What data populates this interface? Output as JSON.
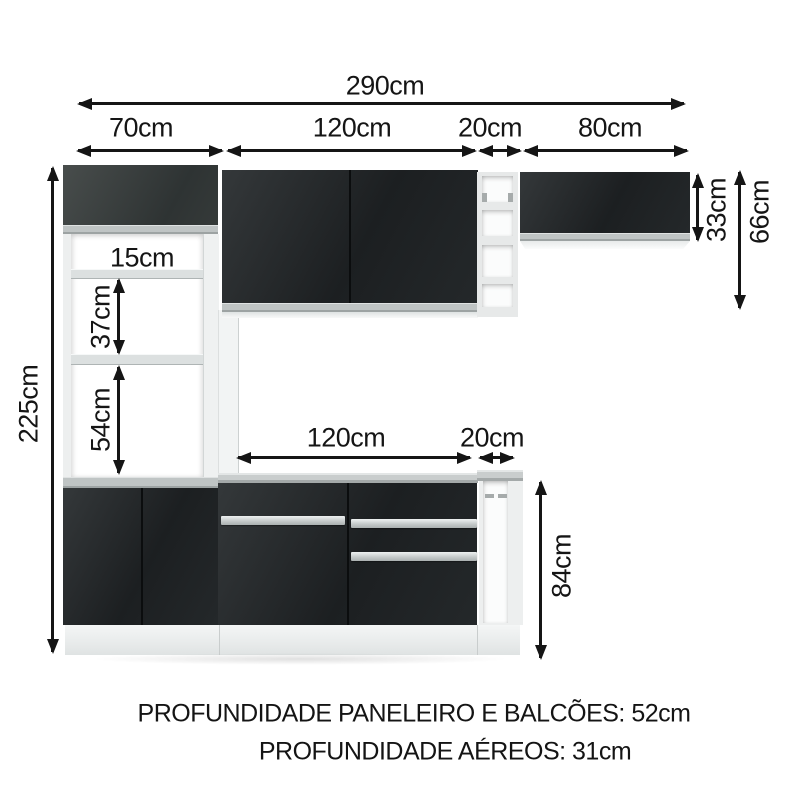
{
  "diagram": {
    "dims": {
      "total_width": "290cm",
      "tall_cabinet_width": "70cm",
      "wall_cabinet_width": "120cm",
      "niche_width": "20cm",
      "right_cabinet_width": "80cm",
      "total_height": "225cm",
      "niche_gap_top": "15cm",
      "niche_gap_middle": "37cm",
      "niche_gap_bottom": "54cm",
      "counter_width": "120cm",
      "counter_side_width": "20cm",
      "counter_height": "84cm",
      "right_cabinet_height": "33cm",
      "right_section_height": "66cm"
    },
    "footer": {
      "line1": "PROFUNDIDADE PANELEIRO E BALCÕES: 52cm",
      "line2": "PROFUNDIDADE AÉREOS: 31cm"
    },
    "colors": {
      "line": "#151515",
      "cabinet_black": "#202325",
      "cabinet_gray_top": "#3d4241",
      "countertop_gray": "#c9cdcd",
      "structure_white": "#f1f3f3",
      "background": "#ffffff"
    }
  }
}
